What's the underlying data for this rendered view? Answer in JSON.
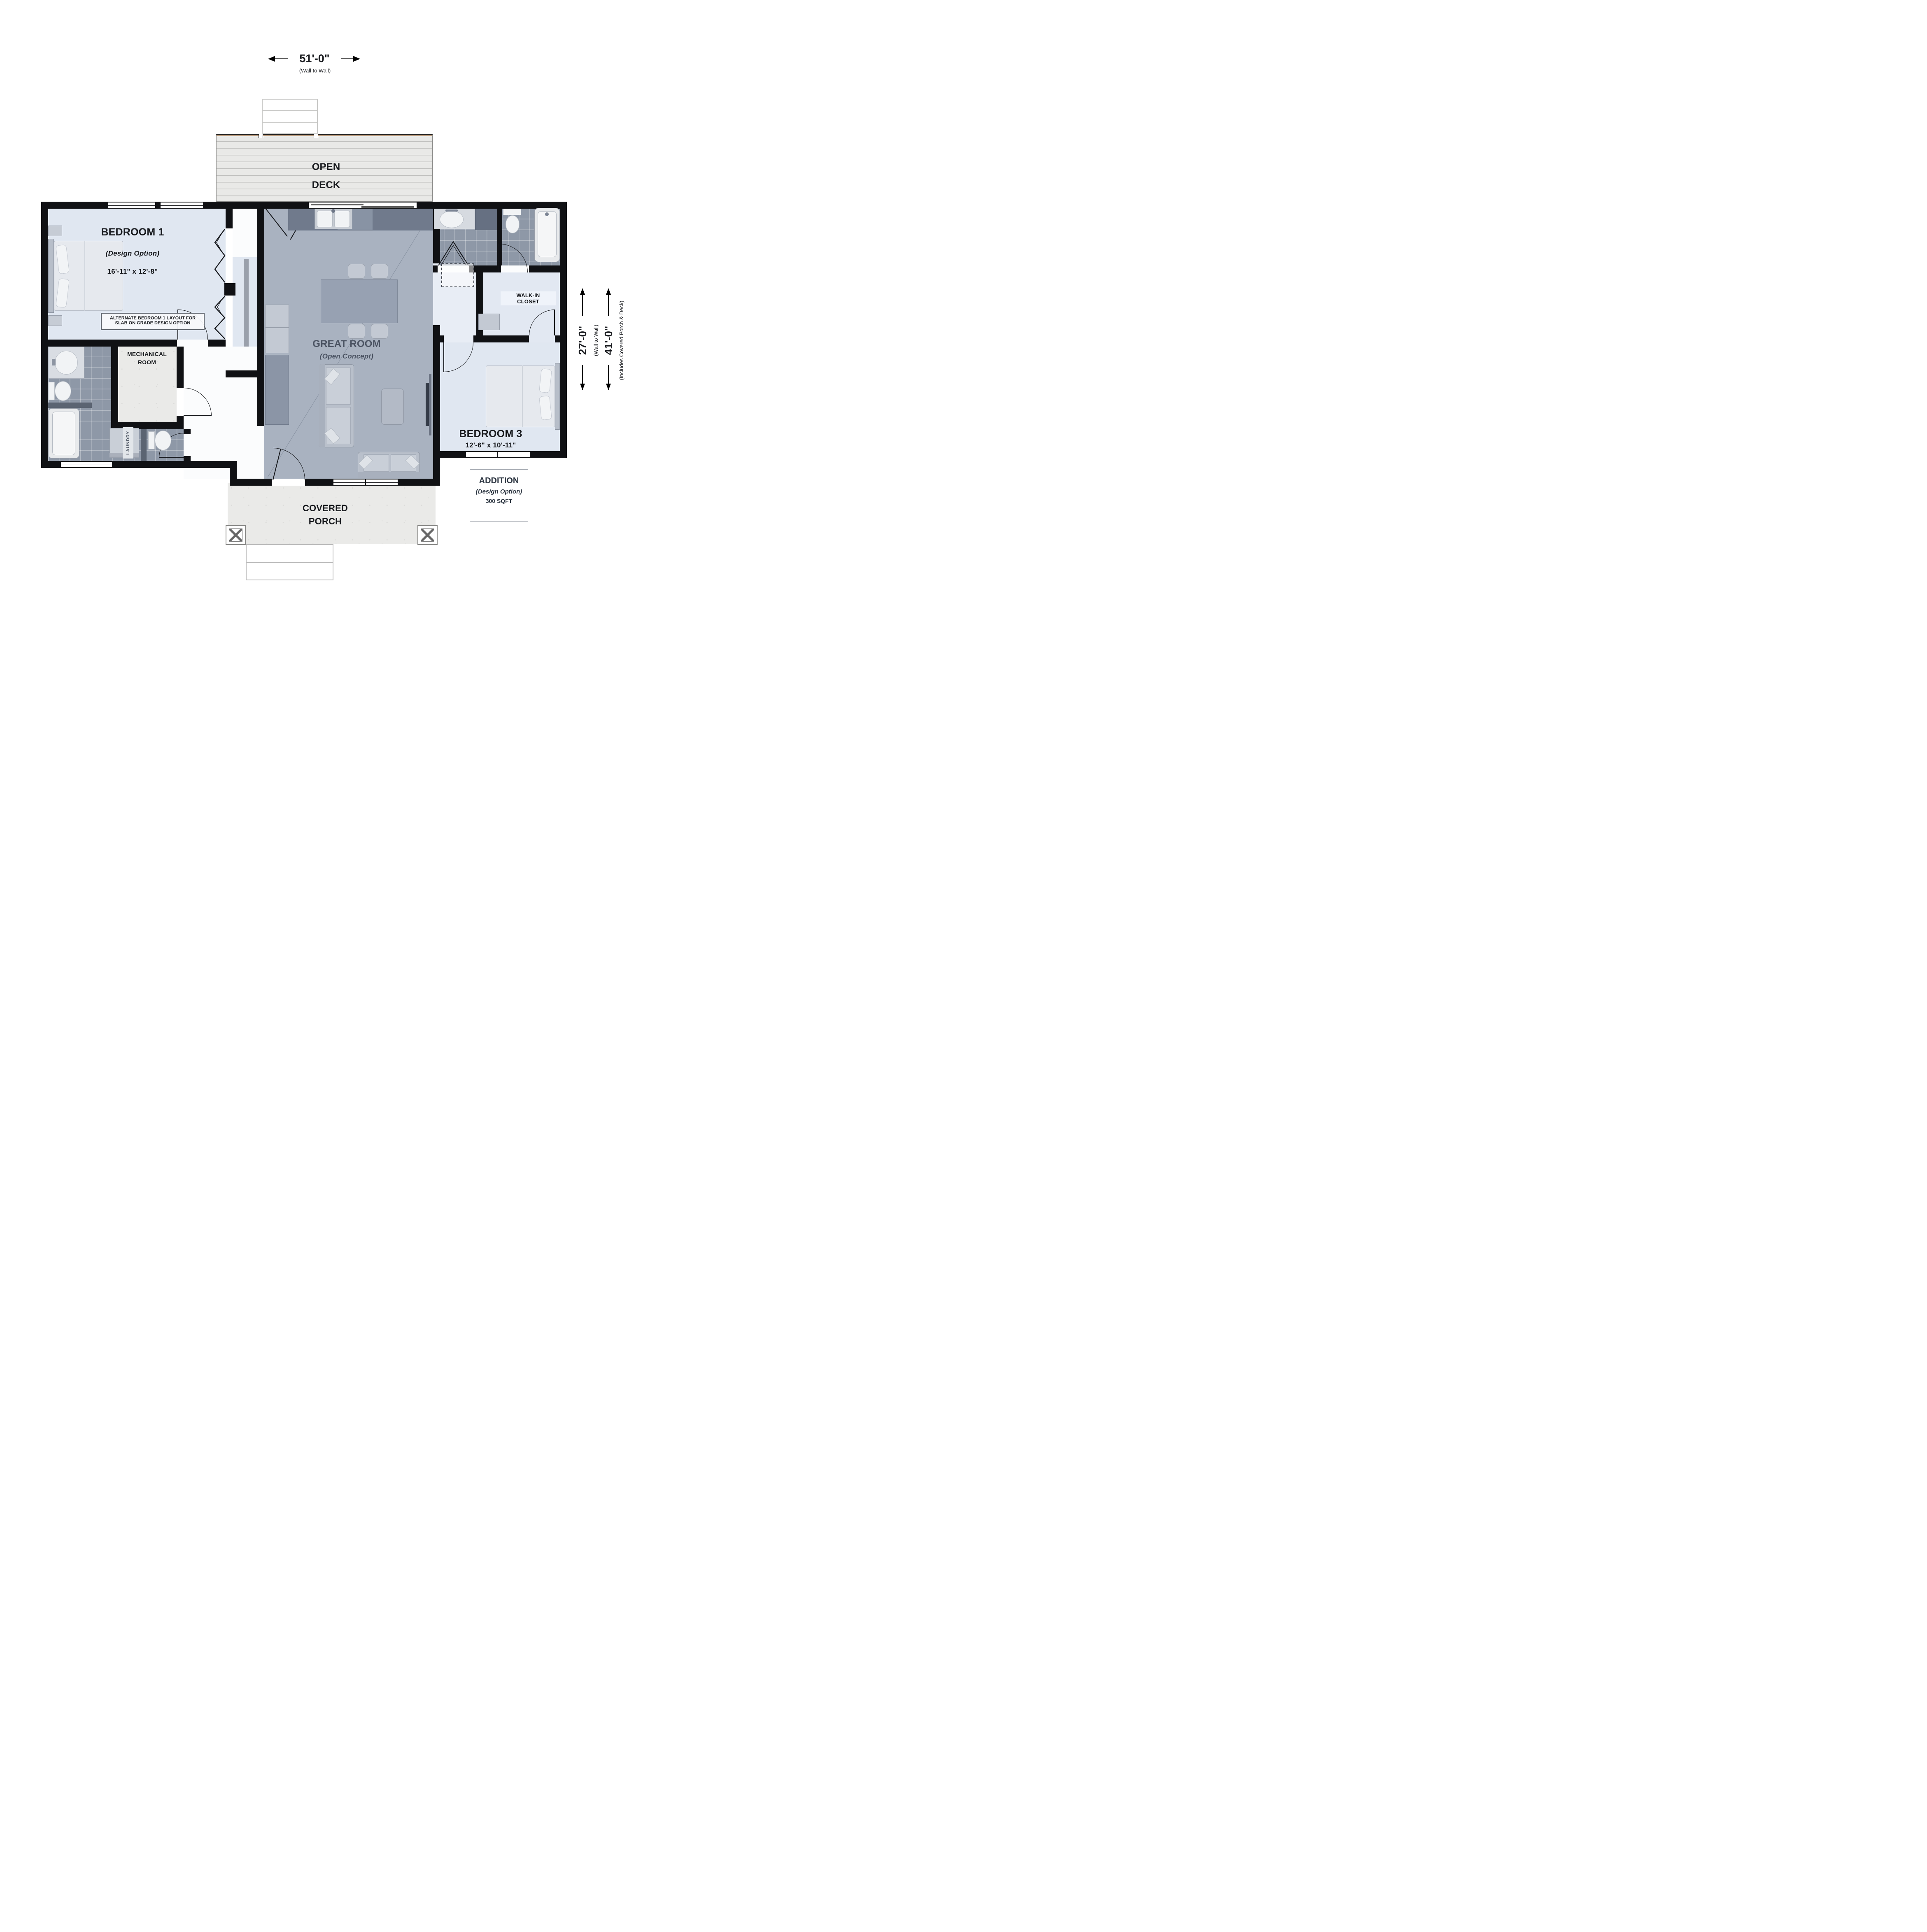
{
  "dimensions": {
    "width": "51'-0\"",
    "width_note": "(Wall to Wall)",
    "depth": "27'-0\"",
    "depth_note": "(Wall to Wall)",
    "total_depth": "41'-0\"",
    "total_depth_note": "(Includes Covered Porch & Deck)"
  },
  "rooms": {
    "open_deck": {
      "line1": "OPEN",
      "line2": "DECK"
    },
    "bedroom1": {
      "name": "BEDROOM 1",
      "option": "(Design Option)",
      "size": "16'-11\" x 12'-8\""
    },
    "alt_note": {
      "line1": "ALTERNATE BEDROOM 1 LAYOUT FOR",
      "line2": "SLAB ON GRADE DESIGN OPTION"
    },
    "mechanical": {
      "line1": "MECHANICAL",
      "line2": "ROOM"
    },
    "great_room": {
      "name": "GREAT ROOM",
      "option": "(Open Concept)"
    },
    "walk_in_closet": {
      "line1": "WALK-IN",
      "line2": "CLOSET"
    },
    "laundry": {
      "label": "LAUNDRY"
    },
    "bedroom3": {
      "name": "BEDROOM 3",
      "size": "12'-6\" x 10'-11\""
    },
    "covered_porch": {
      "line1": "COVERED",
      "line2": "PORCH"
    },
    "addition": {
      "name": "ADDITION",
      "option": "(Design Option)",
      "size": "300 SQFT"
    }
  },
  "colors": {
    "wall": "#101114",
    "bedroom_floor": "#e0e7f1",
    "great_room_floor": "#a9b2c0",
    "tile_floor": "#8e98a7",
    "concrete": "#eaeae8",
    "deck": "#e9e9e7",
    "great_room_text": "#4a5261"
  }
}
